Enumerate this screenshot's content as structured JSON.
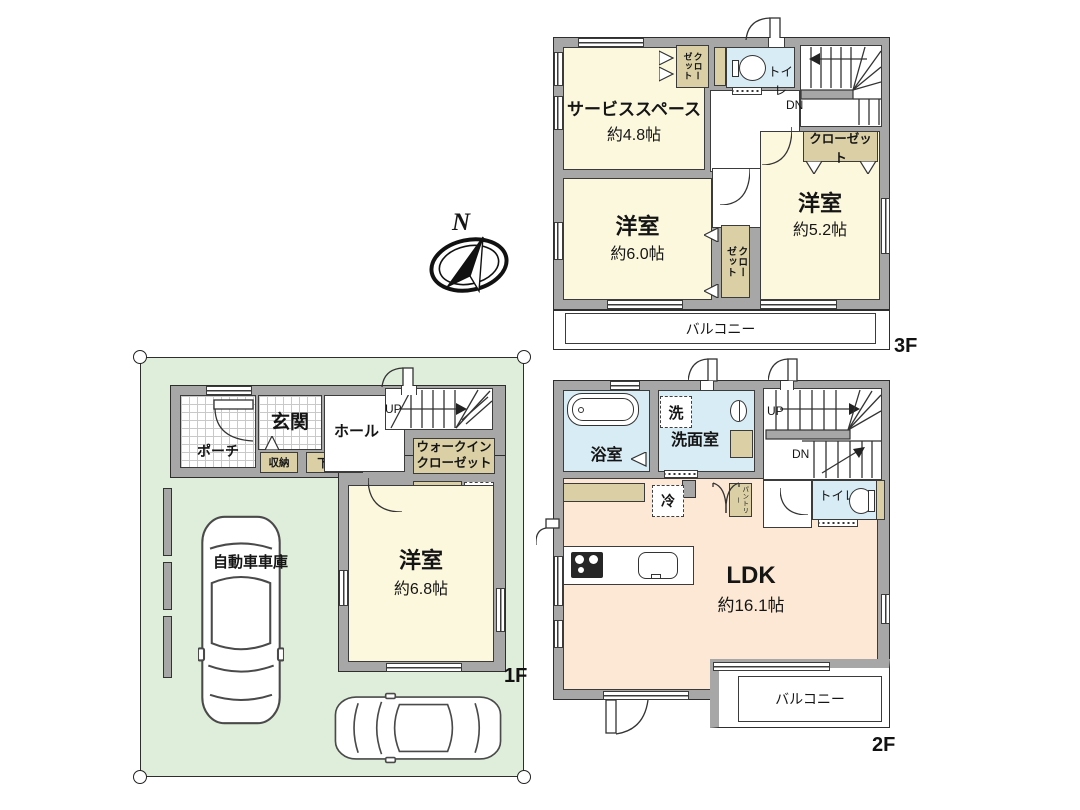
{
  "palette": {
    "wall": "#a7a7a7",
    "line": "#3b3b3b",
    "cream": "#fcf8dd",
    "peach": "#fce8d4",
    "blue": "#d8ecf6",
    "tan": "#dbd0a5",
    "green": "#dfeeda"
  },
  "compass": {
    "north": "N"
  },
  "floor3": {
    "label": "3F",
    "service_space": {
      "name": "サービススペース",
      "size": "約4.8帖"
    },
    "closet_top": "クローゼット",
    "toilet": "トイレ",
    "dn": "DN",
    "closet_right": "クローゼット",
    "room_60": {
      "name": "洋室",
      "size": "約6.0帖"
    },
    "closet_mid": "クローゼット",
    "room_52": {
      "name": "洋室",
      "size": "約5.2帖"
    },
    "balcony": "バルコニー"
  },
  "floor2": {
    "label": "2F",
    "bath": "浴室",
    "washer": "洗",
    "washroom": "洗面室",
    "up": "UP",
    "dn": "DN",
    "toilet": "トイレ",
    "pantry": "パントリー",
    "fridge": "冷",
    "ldk": {
      "name": "LDK",
      "size": "約16.1帖"
    },
    "balcony": "バルコニー"
  },
  "floor1": {
    "label": "1F",
    "porch": "ポーチ",
    "entrance": "玄関",
    "hall": "ホール",
    "up": "UP",
    "storage": "収納",
    "shoe_box": "下足入",
    "walk_in_closet": "ウォークインクローゼット",
    "underfloor_storage": "床下収納",
    "room_68": {
      "name": "洋室",
      "size": "約6.8帖"
    },
    "garage": "自動車車庫"
  }
}
